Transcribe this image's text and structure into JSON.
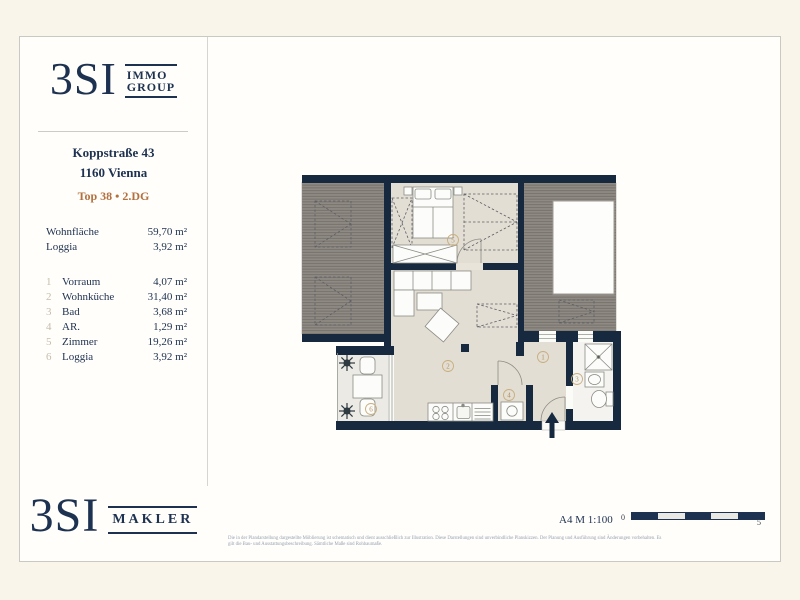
{
  "brand": {
    "logo_text": "3SI",
    "immo_line1": "IMMO",
    "immo_line2": "GROUP",
    "makler_label": "MAKLER",
    "navy": "#1d3150",
    "copper": "#b2703f"
  },
  "listing": {
    "street": "Koppstraße 43",
    "city": "1160 Vienna",
    "unit": "Top 38 • 2.DG"
  },
  "summary": [
    {
      "label": "Wohnfläche",
      "value": "59,70 m²"
    },
    {
      "label": "Loggia",
      "value": "3,92 m²"
    }
  ],
  "rooms": [
    {
      "nr": "1",
      "name": "Vorraum",
      "area": "4,07 m²"
    },
    {
      "nr": "2",
      "name": "Wohnküche",
      "area": "31,40 m²"
    },
    {
      "nr": "3",
      "name": "Bad",
      "area": "3,68 m²"
    },
    {
      "nr": "4",
      "name": "AR.",
      "area": "1,29 m²"
    },
    {
      "nr": "5",
      "name": "Zimmer",
      "area": "19,26 m²"
    },
    {
      "nr": "6",
      "name": "Loggia",
      "area": "3,92 m²"
    }
  ],
  "scale": {
    "sheet_format": "A4  M 1:100",
    "start_label": "0",
    "end_label": "5"
  },
  "disclaimer": {
    "line1": "Die in der Plandarstellung dargestellte Möblierung ist schematisch und dient ausschließlich zur Illustration. Diese Darstellungen sind unverbindliche Planskizzen. Der Planung und Ausführung sind Änderungen vorbehalten. Es",
    "line2": "gilt die Bau- und Ausstattungsbeschreibung. Sämtliche Maße sind Rohbaumaße."
  }
}
